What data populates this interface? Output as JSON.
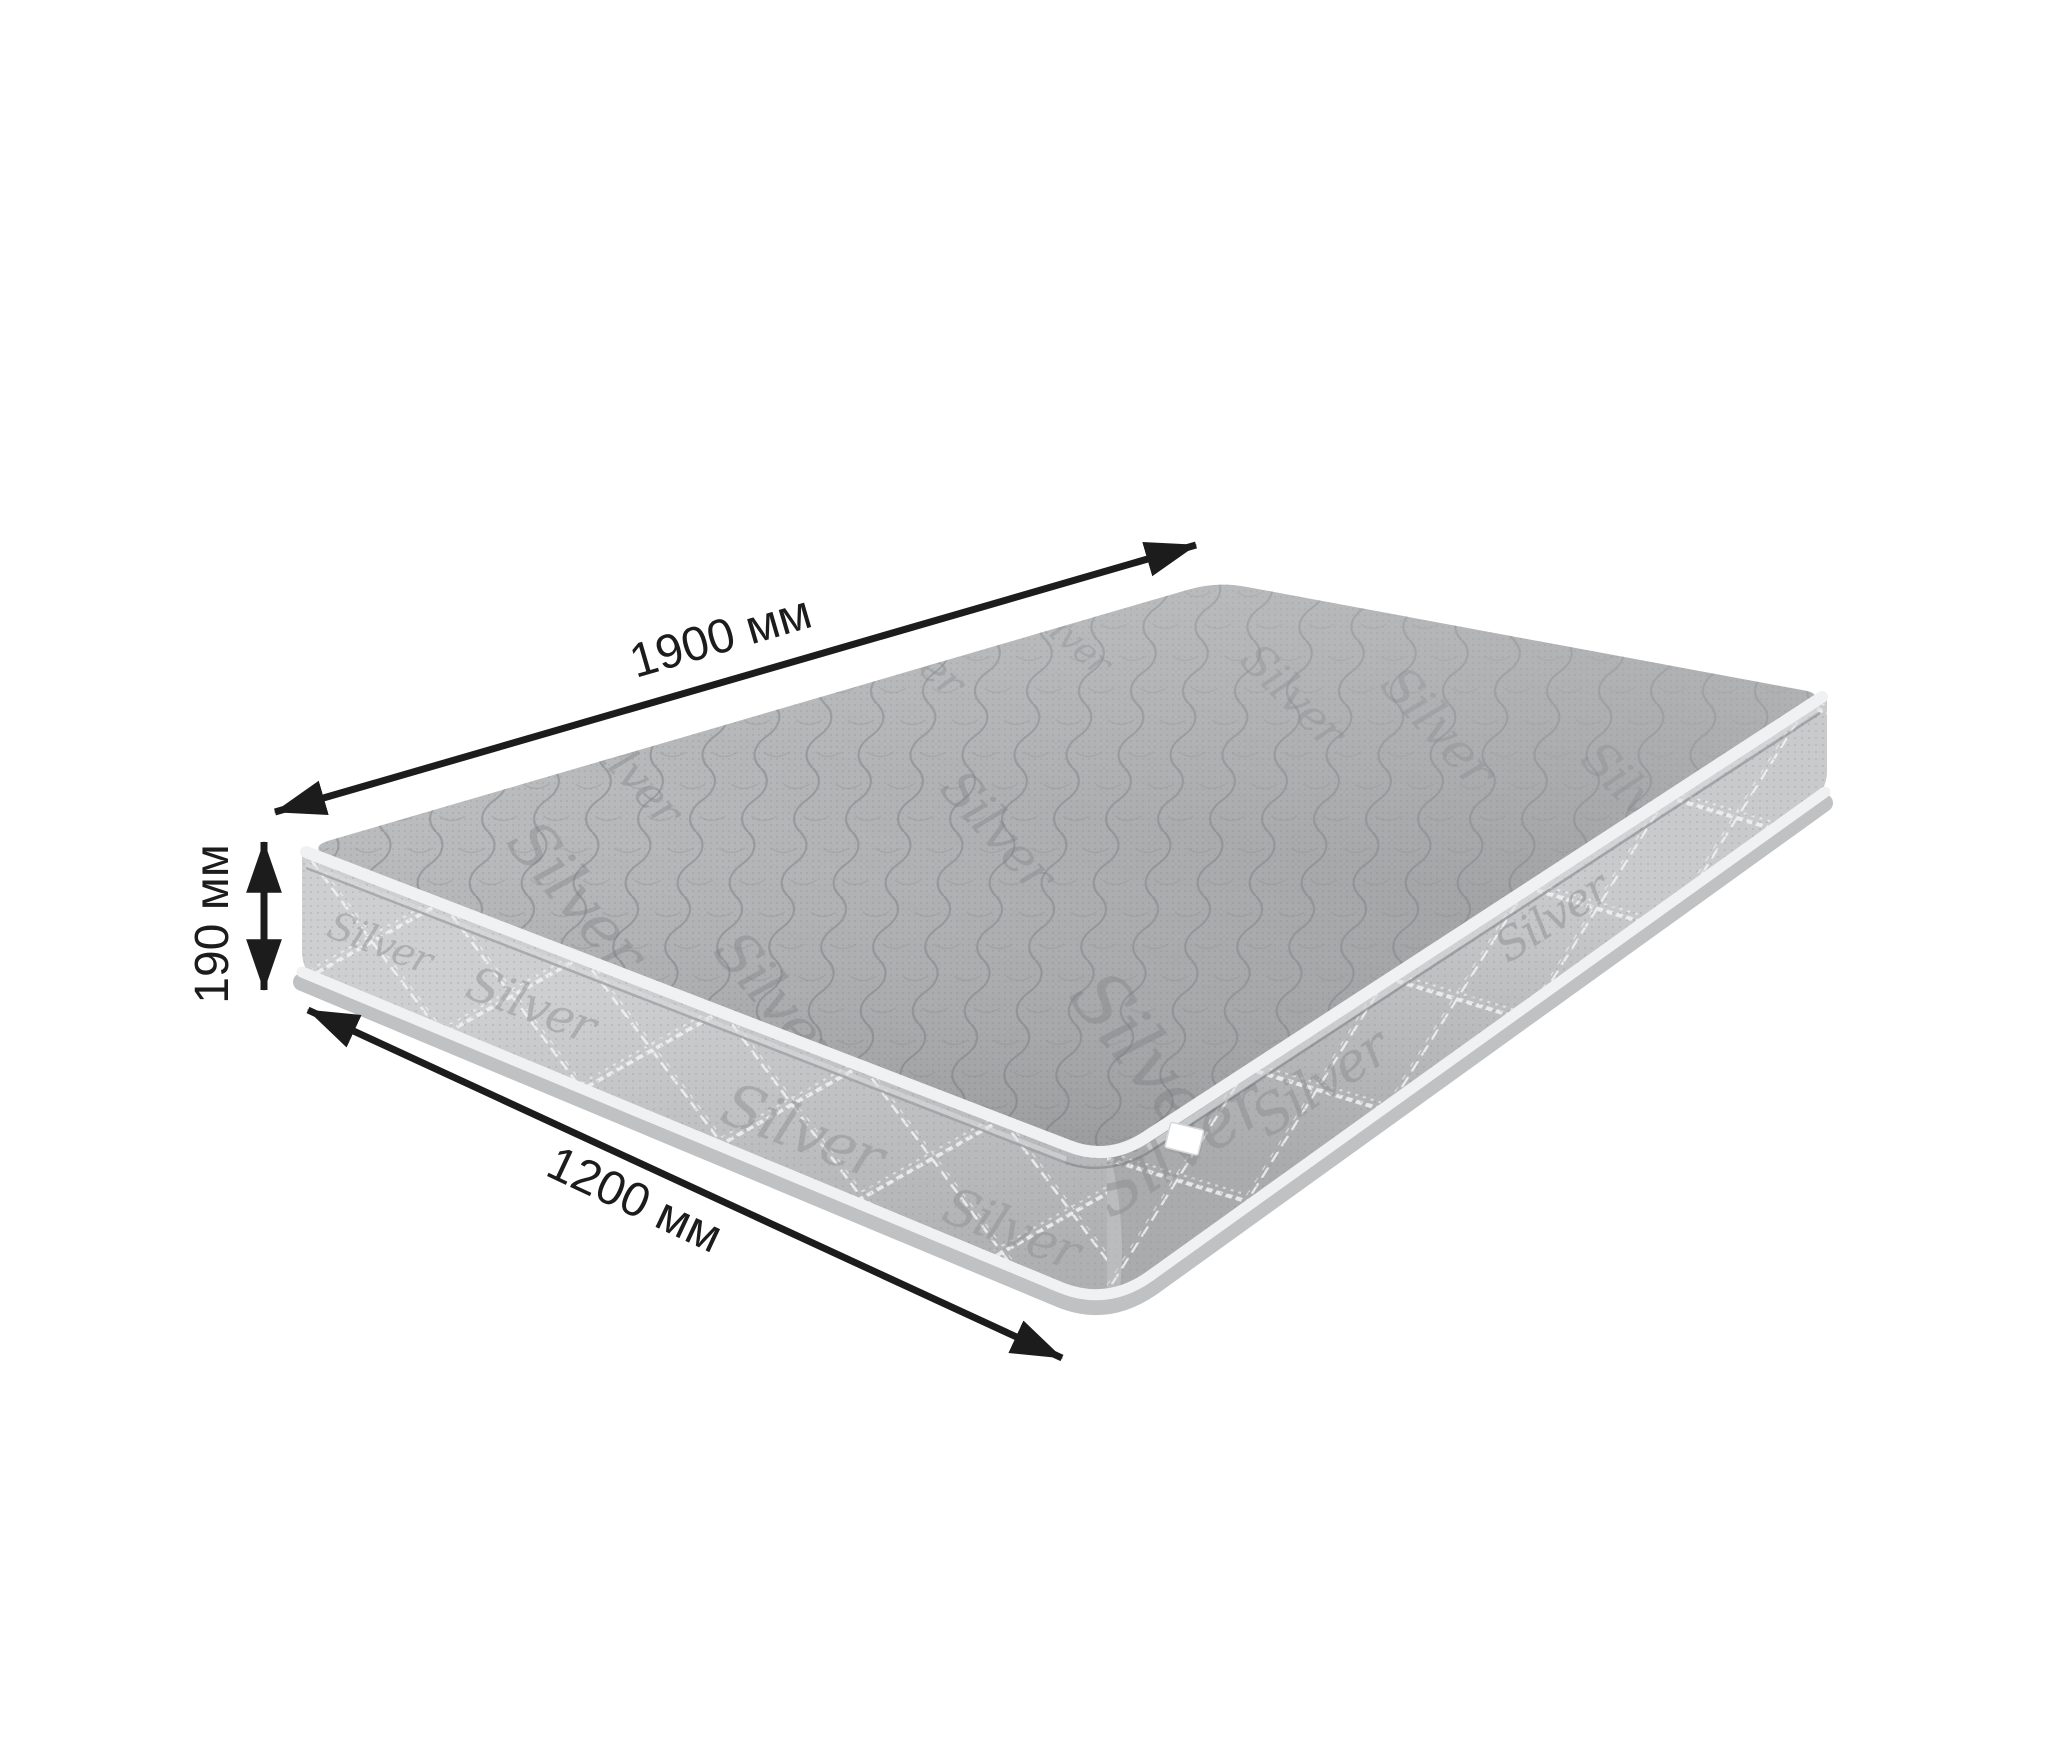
{
  "labels": {
    "length": "1900 мм",
    "height": "190 мм",
    "width": "1200 мм"
  },
  "dimensions_mm": {
    "length": 1900,
    "height": 190,
    "width": 1200,
    "unit": "мм"
  },
  "mattress": {
    "fabric_brand_text": "Silver"
  },
  "colors": {
    "background": "#ffffff",
    "arrow": "#1c1c1c",
    "label_text": "#1c1c1c",
    "fabric_top": "#aaacae",
    "fabric_side": "#c0c2c4",
    "piping": "#f0f1f2",
    "logo_gray": "#85878a",
    "tag": "#ffffff"
  }
}
